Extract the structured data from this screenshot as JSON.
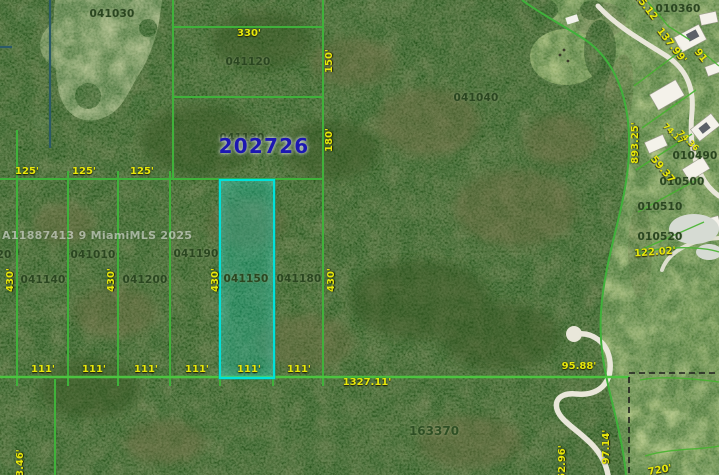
{
  "app": {
    "type": "gis-parcel-aerial-map"
  },
  "watermark": {
    "text": "A11887413 9 MiamiMLS 2025"
  },
  "section_label": {
    "text": "202726"
  },
  "selected_parcel": {
    "id": "041150",
    "highlight_color": "#00e2da"
  },
  "colors": {
    "boundary_green": "#3fb23a",
    "highlight_cyan": "#00e2da",
    "dimension_yellow": "#e8e80a",
    "parcel_label_green": "#2a4720",
    "section_number_blue": "#1c17b2",
    "road_white": "#e9e7da",
    "section_dash_black": "#1e1e1e"
  },
  "labels": [
    {
      "id": "parcel-041030",
      "text": "041030",
      "kind": "parcel",
      "cx": 112,
      "cy": 14,
      "rot": 0
    },
    {
      "id": "parcel-041120",
      "text": "041120",
      "kind": "parcel",
      "cx": 248,
      "cy": 62,
      "rot": 0
    },
    {
      "id": "parcel-041130",
      "text": "041130",
      "kind": "parcel",
      "cx": 242,
      "cy": 138,
      "rot": 0
    },
    {
      "id": "parcel-041040",
      "text": "041040",
      "kind": "parcel",
      "cx": 476,
      "cy": 98,
      "rot": 0
    },
    {
      "id": "parcel-041010",
      "text": "041010",
      "kind": "parcel",
      "cx": 93,
      "cy": 255,
      "rot": 0
    },
    {
      "id": "parcel-041140",
      "text": "041140",
      "kind": "parcel",
      "cx": 43,
      "cy": 280,
      "rot": 0
    },
    {
      "id": "parcel-041200",
      "text": "041200",
      "kind": "parcel",
      "cx": 145,
      "cy": 280,
      "rot": 0
    },
    {
      "id": "parcel-041190",
      "text": "041190",
      "kind": "parcel",
      "cx": 196,
      "cy": 254,
      "rot": 0
    },
    {
      "id": "parcel-041150",
      "text": "041150",
      "kind": "parcel",
      "cx": 246,
      "cy": 279,
      "rot": 0
    },
    {
      "id": "parcel-041180",
      "text": "041180",
      "kind": "parcel",
      "cx": 299,
      "cy": 279,
      "rot": 0
    },
    {
      "id": "parcel-163370",
      "text": "163370",
      "kind": "parcel_lg",
      "cx": 434,
      "cy": 431,
      "rot": 0
    },
    {
      "id": "parcel-partial-20",
      "text": "20",
      "kind": "parcel",
      "cx": 4,
      "cy": 255,
      "rot": 0
    },
    {
      "id": "parcel-010360",
      "text": "010360",
      "kind": "parcel",
      "cx": 678,
      "cy": 9,
      "rot": 0
    },
    {
      "id": "parcel-010490",
      "text": "010490",
      "kind": "parcel",
      "cx": 695,
      "cy": 156,
      "rot": 0
    },
    {
      "id": "parcel-010500",
      "text": "010500",
      "kind": "parcel",
      "cx": 682,
      "cy": 182,
      "rot": 0
    },
    {
      "id": "parcel-010510",
      "text": "010510",
      "kind": "parcel",
      "cx": 660,
      "cy": 207,
      "rot": 0
    },
    {
      "id": "parcel-010520",
      "text": "010520",
      "kind": "parcel",
      "cx": 660,
      "cy": 237,
      "rot": 0
    },
    {
      "id": "dim-330",
      "text": "330'",
      "kind": "dim",
      "cx": 249,
      "cy": 34,
      "rot": 0
    },
    {
      "id": "dim-150",
      "text": "150'",
      "kind": "dim",
      "cx": 330,
      "cy": 61,
      "rot": -90
    },
    {
      "id": "dim-180",
      "text": "180'",
      "kind": "dim",
      "cx": 330,
      "cy": 140,
      "rot": -90
    },
    {
      "id": "dim-125-1",
      "text": "125'",
      "kind": "dim",
      "cx": 27,
      "cy": 172,
      "rot": 0
    },
    {
      "id": "dim-125-2",
      "text": "125'",
      "kind": "dim",
      "cx": 84,
      "cy": 172,
      "rot": 0
    },
    {
      "id": "dim-125-3",
      "text": "125'",
      "kind": "dim",
      "cx": 142,
      "cy": 172,
      "rot": 0
    },
    {
      "id": "dim-430-1",
      "text": "430'",
      "kind": "dim",
      "cx": 11,
      "cy": 280,
      "rot": -90
    },
    {
      "id": "dim-430-2",
      "text": "430'",
      "kind": "dim",
      "cx": 112,
      "cy": 280,
      "rot": -90
    },
    {
      "id": "dim-430-3",
      "text": "430'",
      "kind": "dim",
      "cx": 216,
      "cy": 280,
      "rot": -90
    },
    {
      "id": "dim-430-4",
      "text": "430'",
      "kind": "dim",
      "cx": 332,
      "cy": 280,
      "rot": -90
    },
    {
      "id": "dim-111-1",
      "text": "111'",
      "kind": "dim",
      "cx": 43,
      "cy": 370,
      "rot": 0
    },
    {
      "id": "dim-111-2",
      "text": "111'",
      "kind": "dim",
      "cx": 94,
      "cy": 370,
      "rot": 0
    },
    {
      "id": "dim-111-3",
      "text": "111'",
      "kind": "dim",
      "cx": 146,
      "cy": 370,
      "rot": 0
    },
    {
      "id": "dim-111-4",
      "text": "111'",
      "kind": "dim",
      "cx": 197,
      "cy": 370,
      "rot": 0
    },
    {
      "id": "dim-111-5",
      "text": "111'",
      "kind": "dim",
      "cx": 249,
      "cy": 370,
      "rot": 0
    },
    {
      "id": "dim-111-6",
      "text": "111'",
      "kind": "dim",
      "cx": 299,
      "cy": 370,
      "rot": 0
    },
    {
      "id": "dim-1327-11",
      "text": "1327.11'",
      "kind": "dim",
      "cx": 367,
      "cy": 383,
      "rot": 0
    },
    {
      "id": "dim-95-88",
      "text": "95.88'",
      "kind": "dim",
      "cx": 579,
      "cy": 367,
      "rot": 0
    },
    {
      "id": "dim-893-25",
      "text": "893.25'",
      "kind": "dim",
      "cx": 636,
      "cy": 143,
      "rot": -90
    },
    {
      "id": "dim-137-99",
      "text": "137.99'",
      "kind": "dim",
      "cx": 671,
      "cy": 46,
      "rot": 52
    },
    {
      "id": "dim-15-12",
      "text": "15.12",
      "kind": "dim",
      "cx": 645,
      "cy": 7,
      "rot": 52
    },
    {
      "id": "dim-91",
      "text": "91",
      "kind": "dim",
      "cx": 700,
      "cy": 56,
      "rot": 52
    },
    {
      "id": "dim-59-37",
      "text": "59.37",
      "kind": "dim",
      "cx": 662,
      "cy": 170,
      "rot": 50
    },
    {
      "id": "dim-74-17",
      "text": "74.17",
      "kind": "dim_sm",
      "cx": 673,
      "cy": 134,
      "rot": 45
    },
    {
      "id": "dim-74-36",
      "text": "74.36",
      "kind": "dim_sm",
      "cx": 688,
      "cy": 141,
      "rot": 45
    },
    {
      "id": "dim-122-02",
      "text": "122.02'",
      "kind": "dim",
      "cx": 655,
      "cy": 253,
      "rot": -4
    },
    {
      "id": "dim-152-96",
      "text": "152.96'",
      "kind": "dim",
      "cx": 563,
      "cy": 466,
      "rot": -90
    },
    {
      "id": "dim-97-14",
      "text": "97.14'",
      "kind": "dim",
      "cx": 607,
      "cy": 447,
      "rot": -90
    },
    {
      "id": "dim-720",
      "text": "720'",
      "kind": "dim",
      "cx": 660,
      "cy": 471,
      "rot": -10
    },
    {
      "id": "dim-3-46",
      "text": "3.46'",
      "kind": "dim",
      "cx": 21,
      "cy": 463,
      "rot": -90
    }
  ]
}
